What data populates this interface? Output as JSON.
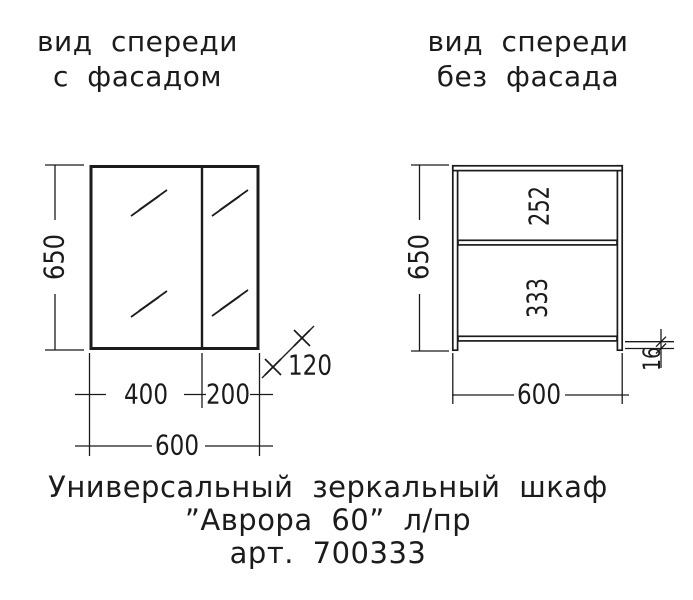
{
  "colors": {
    "ink": "#1b1b1b",
    "paper": "#ffffff"
  },
  "left_view": {
    "title_line1": "вид спереди",
    "title_line2": "с фасадом",
    "dim_height": "650",
    "dim_left_door_width": "400",
    "dim_right_door_width": "200",
    "dim_total_width": "600",
    "dim_depth": "120"
  },
  "right_view": {
    "title_line1": "вид спереди",
    "title_line2": "без фасада",
    "dim_height": "650",
    "dim_upper_section": "252",
    "dim_lower_section": "333",
    "dim_total_width": "600",
    "dim_panel_thickness": "16"
  },
  "caption": {
    "line1": "Универсальный зеркальный шкаф",
    "line2": "”Аврора 60” л/пр",
    "line3": "арт. 700333"
  }
}
